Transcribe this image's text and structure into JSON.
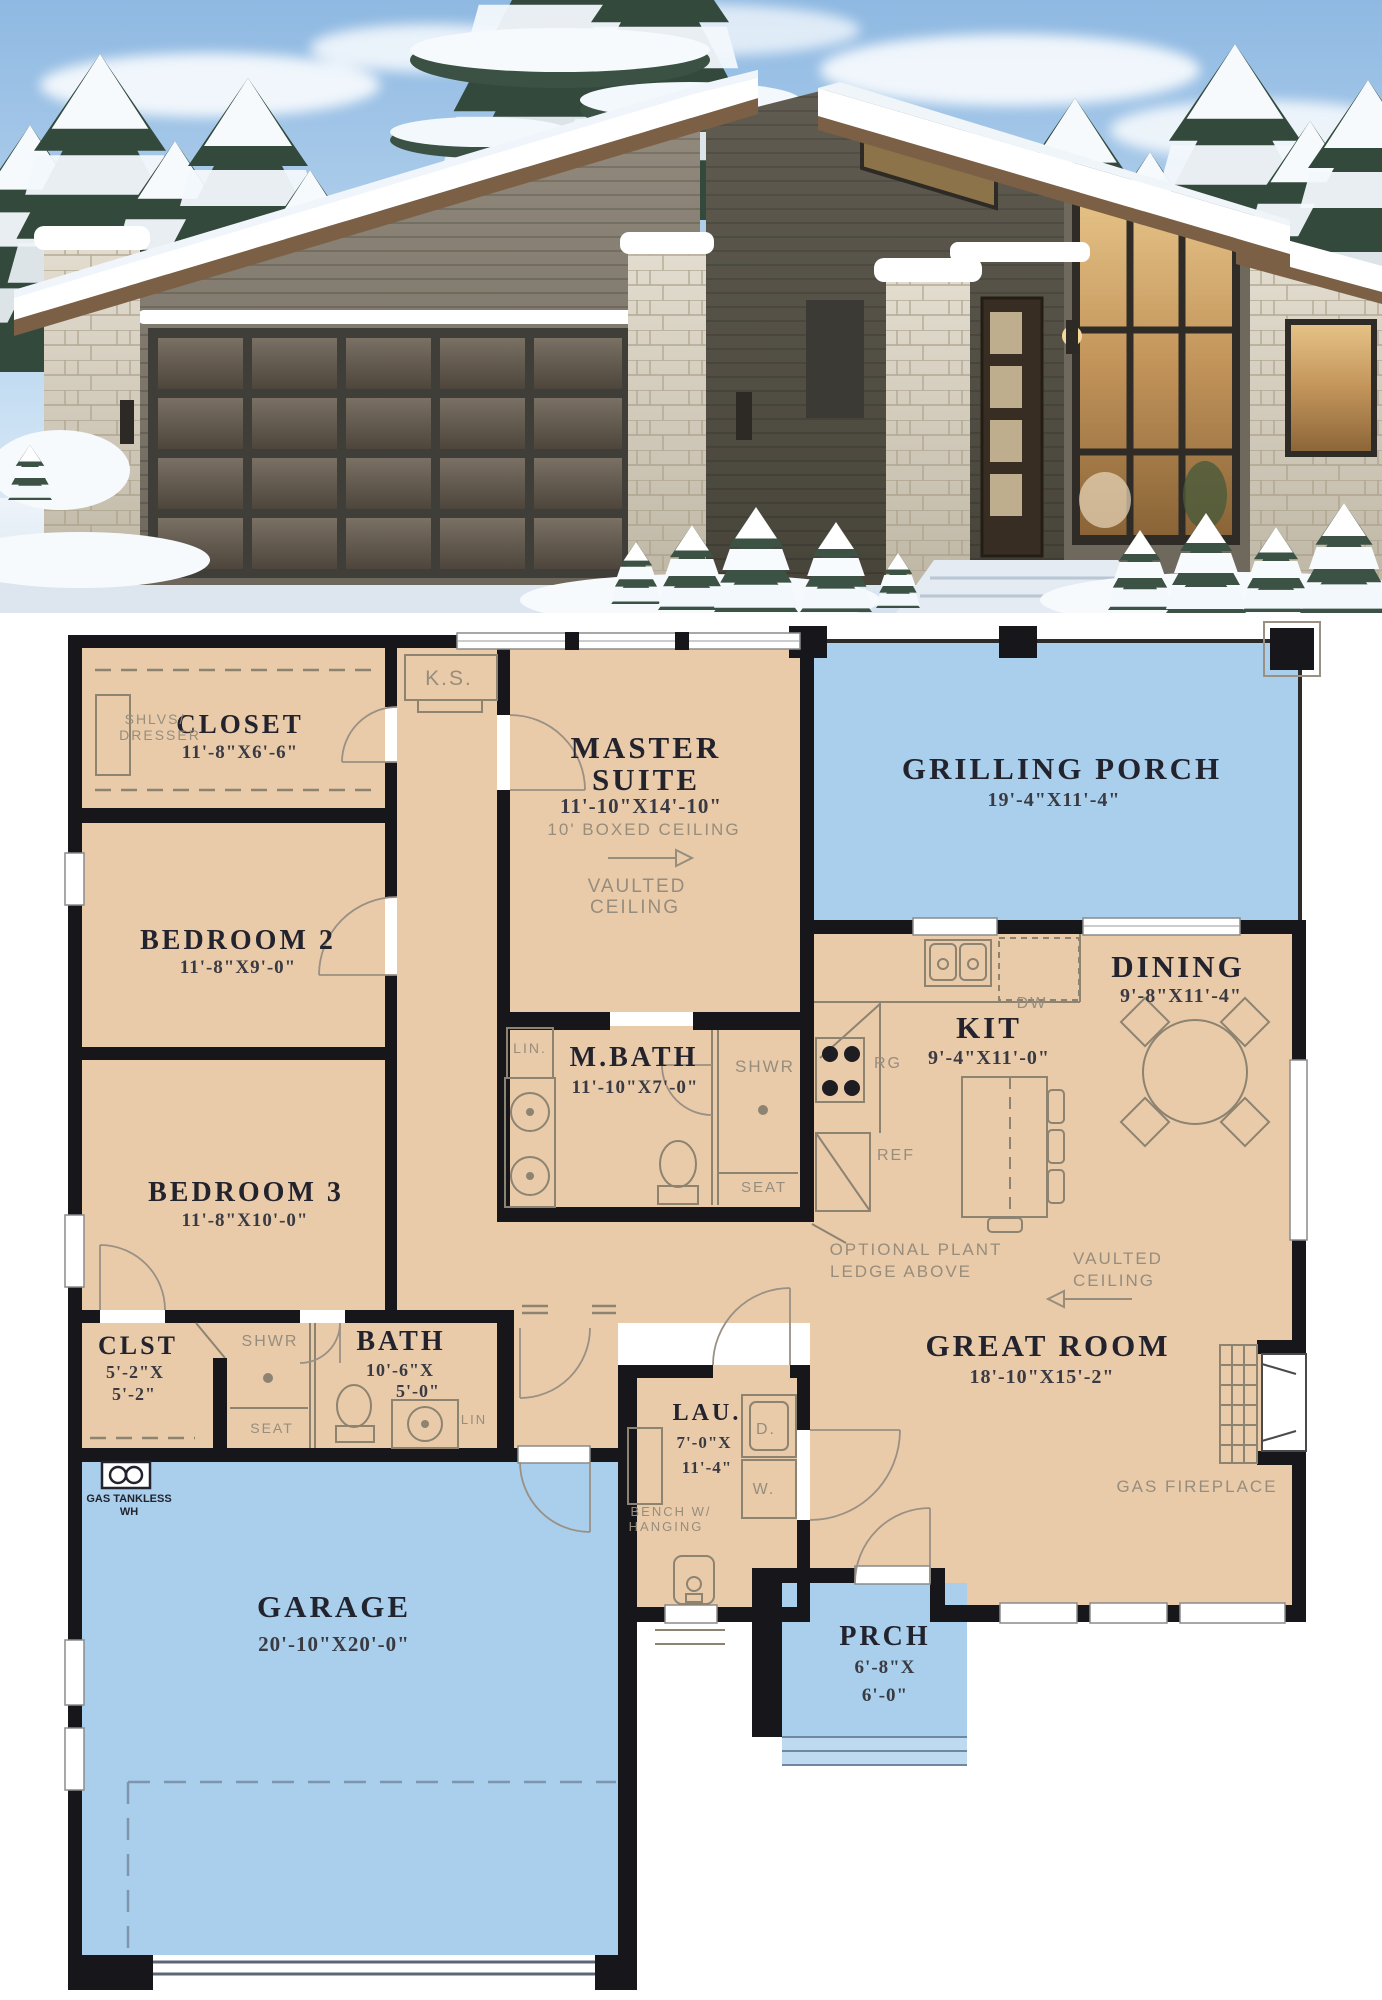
{
  "plan": {
    "closet": {
      "name": "CLOSET",
      "dims": "11'-8\"X6'-6\"",
      "shlvs1": "SHLVS/",
      "shlvs2": "DRESSER",
      "ks": "K.S."
    },
    "master": {
      "name1": "MASTER",
      "name2": "SUITE",
      "dims": "11'-10\"X14'-10\"",
      "ceiling": "10' BOXED CEILING",
      "vault1": "VAULTED",
      "vault2": "CEILING"
    },
    "grilling_porch": {
      "name": "GRILLING PORCH",
      "dims": "19'-4\"X11'-4\""
    },
    "bedroom2": {
      "name": "BEDROOM 2",
      "dims": "11'-8\"X9'-0\""
    },
    "bedroom3": {
      "name": "BEDROOM 3",
      "dims": "11'-8\"X10'-0\""
    },
    "dining": {
      "name": "DINING",
      "dims": "9'-8\"X11'-4\""
    },
    "kitchen": {
      "name": "KIT",
      "dims": "9'-4\"X11'-0\"",
      "dw": "DW",
      "rg": "RG",
      "ref": "REF",
      "plant1": "OPTIONAL PLANT",
      "plant2": "LEDGE ABOVE"
    },
    "mbath": {
      "name": "M.BATH",
      "dims": "11'-10\"X7'-0\"",
      "lin": "LIN.",
      "shwr": "SHWR",
      "seat": "SEAT"
    },
    "great_room": {
      "name": "GREAT ROOM",
      "dims": "18'-10\"X15'-2\"",
      "vault1": "VAULTED",
      "vault2": "CEILING",
      "fireplace": "GAS FIREPLACE"
    },
    "clst": {
      "name": "CLST",
      "dims1": "5'-2\"X",
      "dims2": "5'-2\""
    },
    "hall_bath": {
      "name": "BATH",
      "dims1": "10'-6\"X",
      "dims2": "5'-0\"",
      "shwr": "SHWR",
      "seat": "SEAT",
      "lin": "LIN"
    },
    "laundry": {
      "name": "LAU.",
      "dims1": "7'-0\"X",
      "dims2": "11'-4\"",
      "dryer": "D.",
      "washer": "W.",
      "bench1": "BENCH W/",
      "bench2": "HANGING"
    },
    "water_heater": {
      "line1": "GAS TANKLESS",
      "line2": "WH"
    },
    "garage": {
      "name": "GARAGE",
      "dims": "20'-10\"X20'-0\""
    },
    "porch": {
      "name": "PRCH",
      "dims1": "6'-8\"X",
      "dims2": "6'-0\""
    }
  },
  "palette": {
    "floor": "#e9cbaa",
    "porch_blue": "#a9cfec",
    "porch_step_blue": "#bedaf1",
    "wall": "#17171b",
    "annotation_gray": "#978d7d",
    "label_dark": "#23232e",
    "sky": "#9dc4e8",
    "snow": "#f3f7fb",
    "wood_fascia": "#7b6045",
    "siding": "#827a6e",
    "siding_dark": "#58554c",
    "stone": "#d9d2c3",
    "glass_warm": "#c89a5d"
  }
}
